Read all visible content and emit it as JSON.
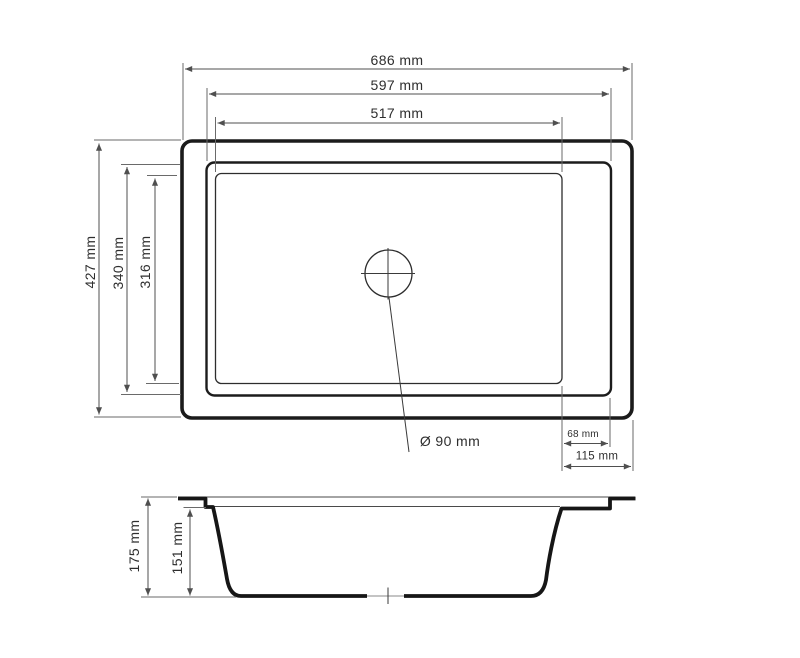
{
  "colors": {
    "outline": "#1b1b1b",
    "dimension_lines": "#4f4f4f",
    "label_text": "#2e2e2e",
    "background": "#ffffff"
  },
  "top_view": {
    "width_overall_label": "686 mm",
    "width_rim_label": "597 mm",
    "width_bowl_label": "517 mm",
    "depth_overall_label": "427 mm",
    "depth_rim_label": "340 mm",
    "depth_bowl_label": "316 mm",
    "right_ledge_label": "68 mm",
    "right_edge_label": "115 mm",
    "drain_label": "Ø 90 mm"
  },
  "side_view": {
    "height_overall_label": "175 mm",
    "bowl_depth_label": "151 mm"
  }
}
